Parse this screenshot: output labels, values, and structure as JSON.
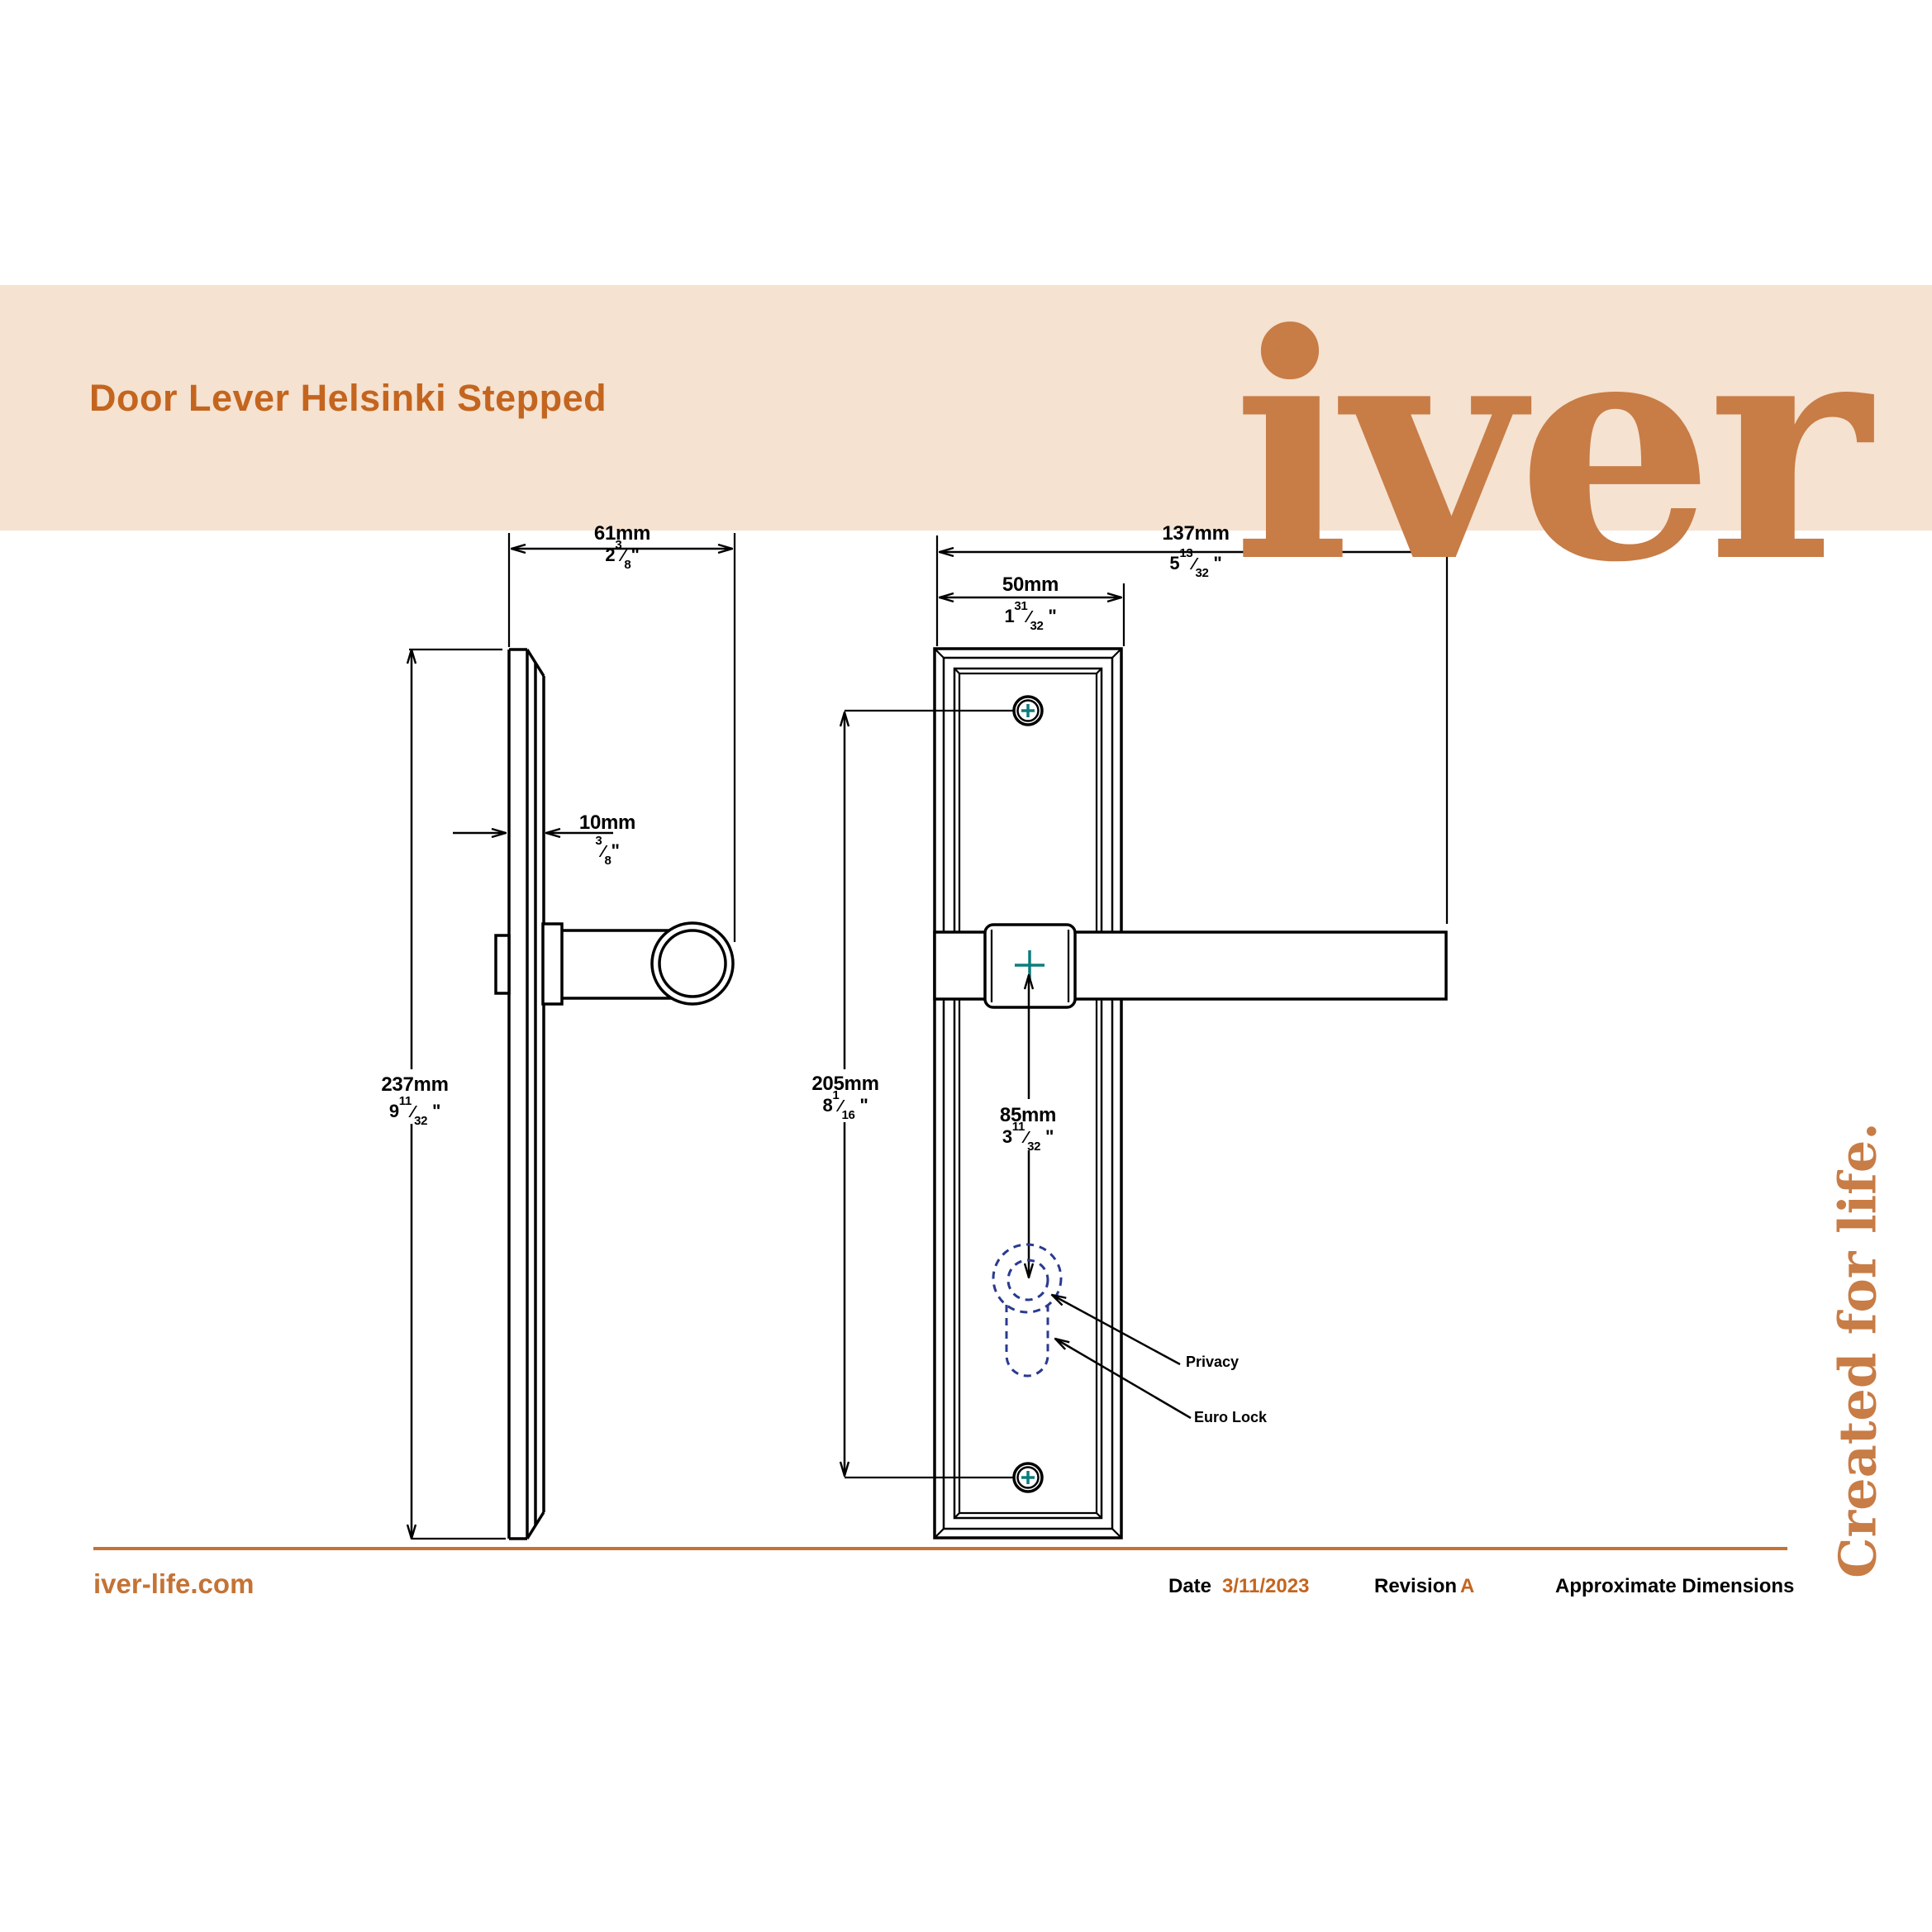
{
  "banner": {
    "title": "Door Lever Helsinki Stepped",
    "logo_text": "iver"
  },
  "tagline": "Created for life.",
  "footer": {
    "website": "iver-life.com",
    "date_label": "Date",
    "date_value": "3/11/2023",
    "revision_label": "Revision",
    "revision_value": "A",
    "note": "Approximate Dimensions"
  },
  "symbols": {
    "fraction_slash": "⁄",
    "inch_mark": "\""
  },
  "dimensions": {
    "overall_width": {
      "mm": "61mm",
      "in_whole": "2",
      "in_num": "3",
      "in_den": "8"
    },
    "projection": {
      "mm": "137mm",
      "in_whole": "5",
      "in_num": "13",
      "in_den": "32"
    },
    "plate_width": {
      "mm": "50mm",
      "in_whole": "1",
      "in_num": "31",
      "in_den": "32"
    },
    "plate_height": {
      "mm": "237mm",
      "in_whole": "9",
      "in_num": "11",
      "in_den": "32"
    },
    "plate_thickness": {
      "mm": "10mm",
      "in_whole": "",
      "in_num": "3",
      "in_den": "8"
    },
    "screw_centres": {
      "mm": "205mm",
      "in_whole": "8",
      "in_num": "1",
      "in_den": "16"
    },
    "spindle_to_lock": {
      "mm": "85mm",
      "in_whole": "3",
      "in_num": "11",
      "in_den": "32"
    }
  },
  "annotations": {
    "privacy": "Privacy",
    "euro_lock": "Euro Lock"
  },
  "colors": {
    "accent_orange": "#C4651F",
    "logo_orange": "#C87C46",
    "banner_bg": "#F5E2D0",
    "rule_orange": "#C47335",
    "teal_cross": "#0E7C7E",
    "keyhole_navy": "#2B3A8F",
    "line_black": "#000000"
  }
}
